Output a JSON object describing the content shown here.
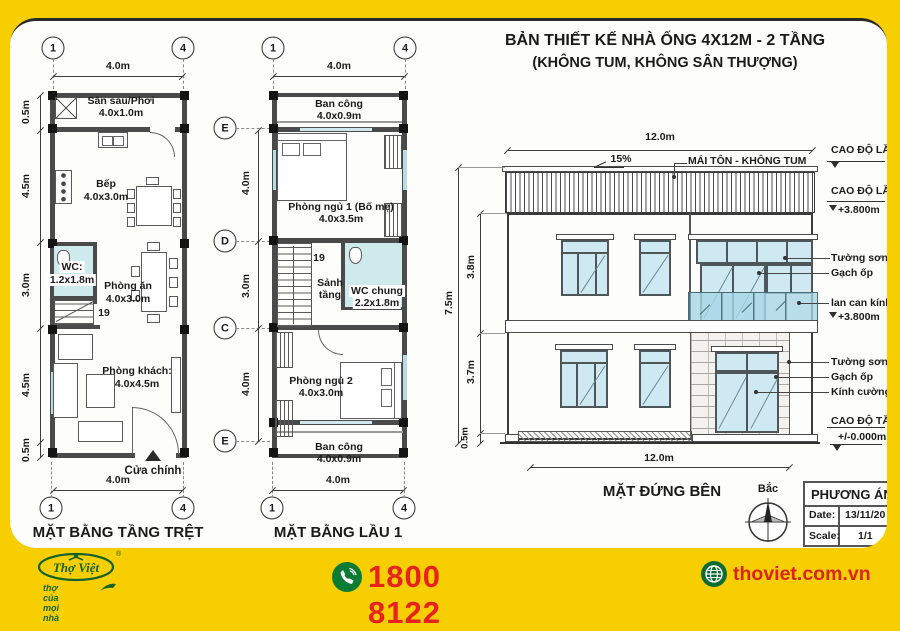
{
  "header": {
    "title_line1": "BẢN THIẾT KẾ NHÀ ỐNG 4X12M - 2 TẦNG",
    "title_line2": "(KHÔNG TUM, KHÔNG SÂN THƯỢNG)"
  },
  "ground_plan": {
    "title": "MẶT BẰNG TẦNG TRỆT",
    "grid_cols": [
      "1",
      "4"
    ],
    "dim_width": "4.0m",
    "dims_left": [
      "0.5m",
      "4.5m",
      "3.0m",
      "4.5m",
      "0.5m"
    ],
    "rooms": {
      "laundry": {
        "name": "Sân sau/Phơi",
        "size": "4.0x1.0m"
      },
      "kitchen": {
        "name": "Bếp",
        "size": "4.0x3.0m"
      },
      "wc": {
        "name": "WC:",
        "size": "1.2x1.8m"
      },
      "dining": {
        "name": "Phòng ăn",
        "size": "4.0x3.0m"
      },
      "living": {
        "name": "Phòng khách:",
        "size": "4.0x4.5m"
      }
    },
    "stair_count": "19",
    "main_door": "Cửa chính"
  },
  "floor1_plan": {
    "title": "MẶT BẰNG LẦU 1",
    "grid_cols": [
      "1",
      "4"
    ],
    "grid_rows": [
      "E",
      "D",
      "C",
      "E"
    ],
    "dim_width": "4.0m",
    "dims_left": [
      "4.0m",
      "3.0m",
      "4.0m"
    ],
    "rooms": {
      "balcony_top": {
        "name": "Ban công",
        "size": "4.0x0.9m"
      },
      "bedroom1": {
        "name": "Phòng ngủ 1 (Bố mẹ)",
        "size": "4.0x3.5m"
      },
      "hall": {
        "name": "Sảnh tầng"
      },
      "wc": {
        "name": "WC chung",
        "size": "2.2x1.8m"
      },
      "bedroom2": {
        "name": "Phòng ngủ 2",
        "size": "4.0x3.0m"
      },
      "balcony_bottom": {
        "name": "Ban công",
        "size": "4.0x0.9m"
      }
    },
    "stair_count": "19"
  },
  "elevation": {
    "title": "MẶT ĐỨNG BÊN",
    "dim_width_top": "12.0m",
    "dim_width_bottom": "12.0m",
    "roof_slope": "15%",
    "roof_label": "MÁI TÔN - KHÔNG TUM",
    "dims_left": [
      "7.5m",
      "3.8m",
      "3.7m",
      "0.5m"
    ],
    "levels": {
      "floor2": "CAO ĐỘ LẦU 2",
      "floor1": "CAO ĐỘ LẦU 1",
      "floor1_value": "+3.800m",
      "rail_value": "+3.800m",
      "ground": "CAO ĐỘ TẦNG TRỆT",
      "ground_value": "+/-0.000m"
    },
    "callouts": {
      "wall_paint_upper": "Tường sơn",
      "tiles_upper": "Gạch ốp",
      "glass_railing": "lan can kính",
      "wall_paint_lower": "Tường sơn",
      "tiles_lower": "Gạch ốp",
      "tempered_glass": "Kính cường lực"
    },
    "compass_north": "Bắc",
    "title_block": {
      "title": "PHƯƠNG ÁN",
      "date_label": "Date:",
      "date_value": "13/11/20",
      "scale_label": "Scale:",
      "scale_value": "1/1"
    }
  },
  "footer": {
    "brand": "Thợ Việt",
    "registered": "®",
    "tagline": "thợ của mọi nhà",
    "phone": "1800 8122",
    "website": "thoviet.com.vn"
  },
  "colors": {
    "frame_yellow": "#F7CE00",
    "accent_red": "#E7221D",
    "brand_green": "#14632B",
    "glass_blue": "#CFE9F2"
  }
}
